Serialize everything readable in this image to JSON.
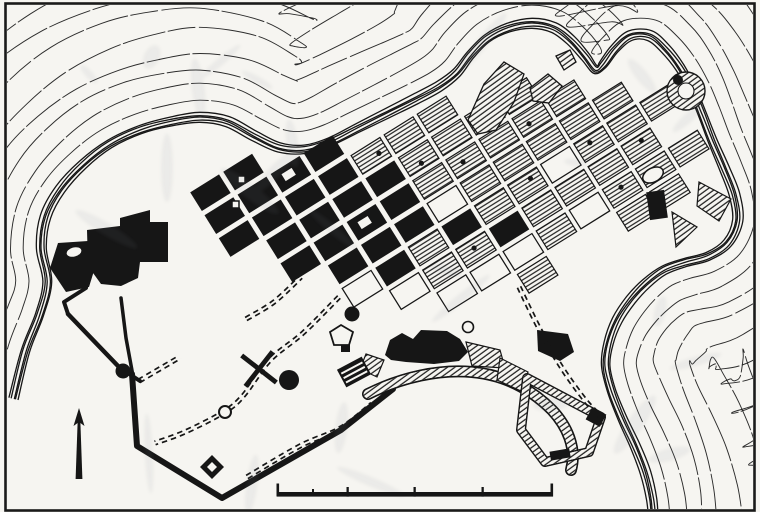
{
  "figure": {
    "type": "scanned-city-plan-map",
    "description": "Black-and-white archaeological plan of a walled coastal town: orthogonal street grid of solid-black and hatched blocks, perimeter city wall, dashed road traces, terrain contour lines along the coast, north arrow and scale bar. No text labels are printed on the map.",
    "colors": {
      "paper": "#f6f5f1",
      "outside": "#ffffff",
      "ink": "#161616",
      "ghost": "#818893"
    },
    "frame": {
      "visible": true
    }
  },
  "map": {
    "grid_rows": [
      "bb..........",
      "bbbb........",
      "bbbbhhh.....",
      ".bbbbhhhh...",
      ".bbbbhhhhh..",
      "..bbbwhhhhh.",
      "..wbhbhhwhhh",
      "...whhbhhhh.",
      "....wwwhwhhh",
      "......h..hh."
    ],
    "block_marks": [
      [
        4,
        2
      ],
      [
        5,
        3
      ],
      [
        7,
        3
      ],
      [
        6,
        4
      ],
      [
        8,
        4
      ],
      [
        7,
        6
      ],
      [
        9,
        6
      ],
      [
        5,
        7
      ],
      [
        10,
        7
      ],
      [
        9,
        8
      ]
    ],
    "white_holes": [
      [
        2,
        1
      ],
      [
        3,
        4
      ]
    ],
    "north_arrow": {
      "points_up": true
    },
    "scale_bar": {
      "major_tick_xs": [
        277,
        347,
        414,
        482,
        551
      ],
      "minor_tick_xs": [
        312
      ],
      "y": 492,
      "length": 276
    }
  }
}
